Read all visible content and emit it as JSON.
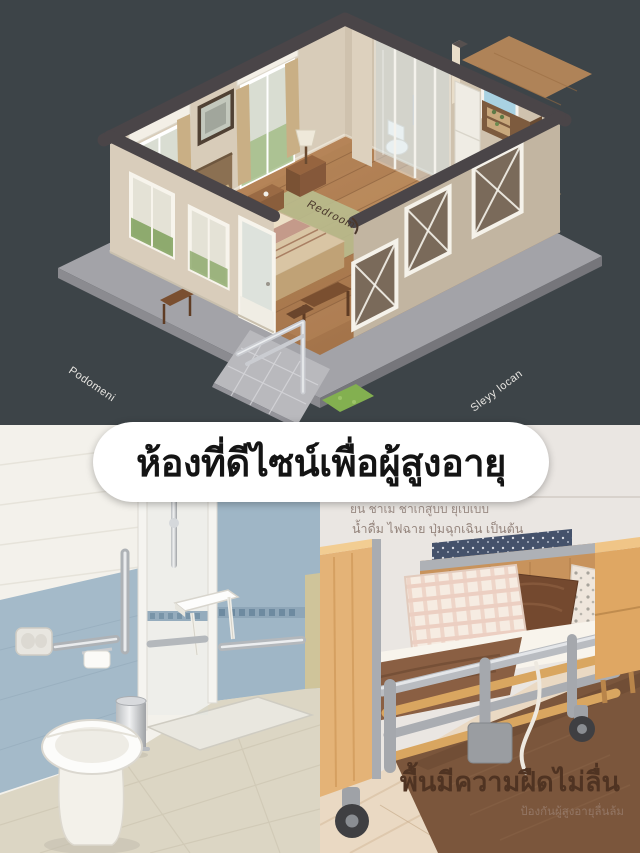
{
  "colors": {
    "background": "#3d4448",
    "banner_bg": "#ffffff",
    "banner_text": "#141414",
    "bathroom_wall_blue": "#a4bac9",
    "wood_floor": "#b5895c",
    "rug_brown": "#7b563c",
    "caption_brown": "#4f3322"
  },
  "floorplan": {
    "label_bottom_left": "Podomeni",
    "label_bottom_right": "Sleyy locan",
    "label_room": "Redroom"
  },
  "banner": {
    "text": "ห้องที่ดีไซน์เพื่อผู้สูงอายุ"
  },
  "bed_photo": {
    "caption_line1": "ยน ชาเม ชาเกสูบบ ยุเบเบบ",
    "caption_line2": "น้ำดื่ม ไฟฉาย ปุ่มฉุกเฉิน เป็นต้น",
    "caption_main": "พื้นมีความฝืดไม่ลื่น",
    "caption_sub": "ป้องกันผู้สูงอายุลื่นล้ม"
  }
}
